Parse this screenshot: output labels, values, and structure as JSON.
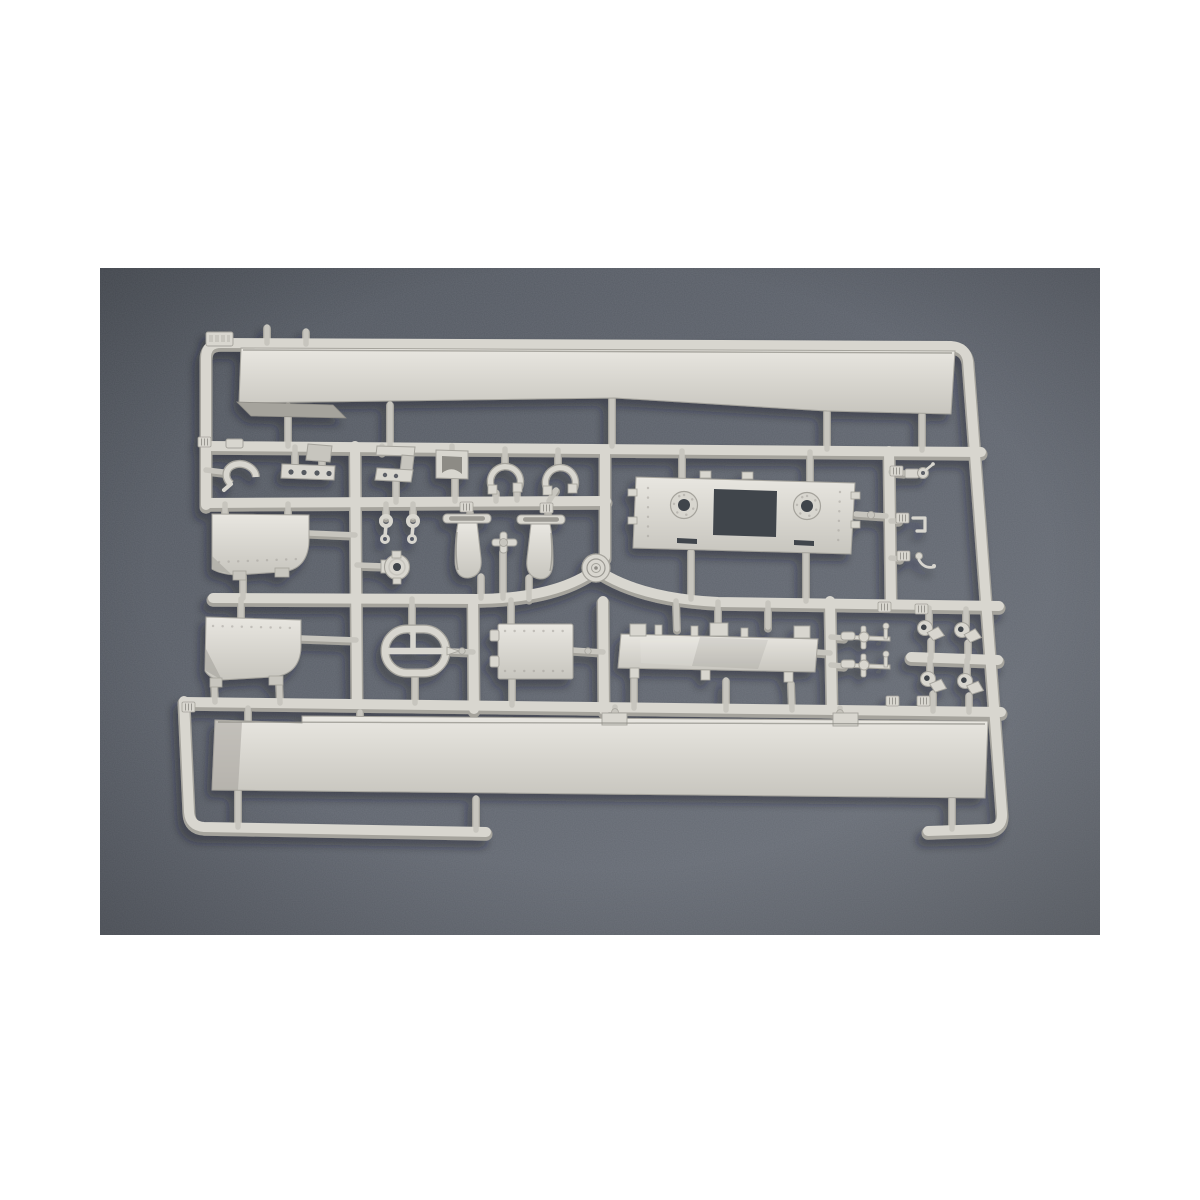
{
  "image": {
    "type": "product-photo",
    "subject": "plastic model kit sprue (injection-moulded parts tree) in light grey styrene, photographed from above",
    "background": "dark grey textured surface with white page border",
    "text_visible": "none legible"
  },
  "palette": {
    "page_bg": "#ffffff",
    "photo_bg": "#60656e",
    "photo_bg_dark": "#50555d",
    "photo_bg_light": "#6f747c",
    "plastic_base": "#d8d6cf",
    "plastic_light": "#e8e6e0",
    "plastic_mid": "#c7c5be",
    "plastic_dark": "#a5a39c",
    "plastic_crease": "#8d8b85",
    "hole_dark": "#3f444c",
    "shadow": "#171a20"
  },
  "photo": {
    "left": 100,
    "top": 268,
    "width": 1000,
    "height": 667
  },
  "sprue": {
    "material": "light grey polystyrene",
    "frame_tag": {
      "present": true,
      "text_legible": false,
      "location": "top-left corner of frame"
    },
    "parts": [
      {
        "name": "upper-side-panel",
        "description": "long flat side panel moulded under the top rail, angled flap at lower-left end"
      },
      {
        "name": "lower-side-panel",
        "description": "long flat side panel moulded above the bottom rail, two tabs on top edge"
      },
      {
        "name": "deck-plate",
        "description": "wide plate with two round ring openings, central rectangular cutout and two slots"
      },
      {
        "name": "skirt-strip",
        "description": "long narrow strip with three mounting clips on its top edge"
      },
      {
        "name": "access-panel-upper",
        "description": "rounded-corner riveted panel with two hinge tabs"
      },
      {
        "name": "access-panel-lower",
        "description": "rounded-corner riveted panel with two hinge tabs"
      },
      {
        "name": "hatch-door",
        "description": "small rectangular door with two hinge knuckles and rivet rows"
      },
      {
        "name": "oval-loop",
        "description": "racetrack-shaped loop with centre cross bar and pointed gate"
      },
      {
        "name": "exhaust-shroud-left",
        "description": "tapered shroud piece with slotted mounting bar"
      },
      {
        "name": "exhaust-shroud-right",
        "description": "tapered shroud piece with slotted mounting bar"
      },
      {
        "name": "cross-fitting",
        "description": "small four-way pipe fitting between the shrouds"
      },
      {
        "name": "round-pump-body",
        "description": "round body with centre hole and side flange"
      },
      {
        "name": "hub-cap-disc",
        "description": "ribbed round disc moulded at the runner junction"
      },
      {
        "name": "u-clamp-left",
        "description": "U-shaped clamp with square feet"
      },
      {
        "name": "u-clamp-right",
        "description": "U-shaped clamp with square feet"
      },
      {
        "name": "saddle-channel",
        "description": "small U-channel saddle piece"
      },
      {
        "name": "step-bracket",
        "description": "stepped angle bracket with drilled base flange"
      },
      {
        "name": "drilled-strip",
        "description": "flat strip with four holes"
      },
      {
        "name": "small-plate",
        "description": "small flat plate above the drilled strip"
      },
      {
        "name": "angle-clip",
        "description": "small clip on the upper-left cross runner"
      },
      {
        "name": "c-hook",
        "description": "open C-shaped hook"
      },
      {
        "name": "link-pair",
        "description": "two small chain-link pieces"
      },
      {
        "name": "torsion-arm-upper",
        "description": "cross-shaped axle arm with end pin and ball"
      },
      {
        "name": "torsion-arm-lower",
        "description": "cross-shaped axle arm with end pin and ball"
      },
      {
        "name": "shackle-1",
        "description": "towing shackle with drilled eye"
      },
      {
        "name": "shackle-2",
        "description": "towing shackle with drilled eye"
      },
      {
        "name": "shackle-3",
        "description": "towing shackle with drilled eye"
      },
      {
        "name": "shackle-4",
        "description": "towing shackle with drilled eye"
      },
      {
        "name": "winch-crank",
        "description": "small drum with crank handle"
      },
      {
        "name": "square-hook",
        "description": "square-bent wire hook"
      },
      {
        "name": "valve-fitting",
        "description": "small pin with curled valve arm"
      },
      {
        "name": "runner-tabs",
        "description": "ribbed locating tabs moulded along the runners"
      }
    ]
  }
}
